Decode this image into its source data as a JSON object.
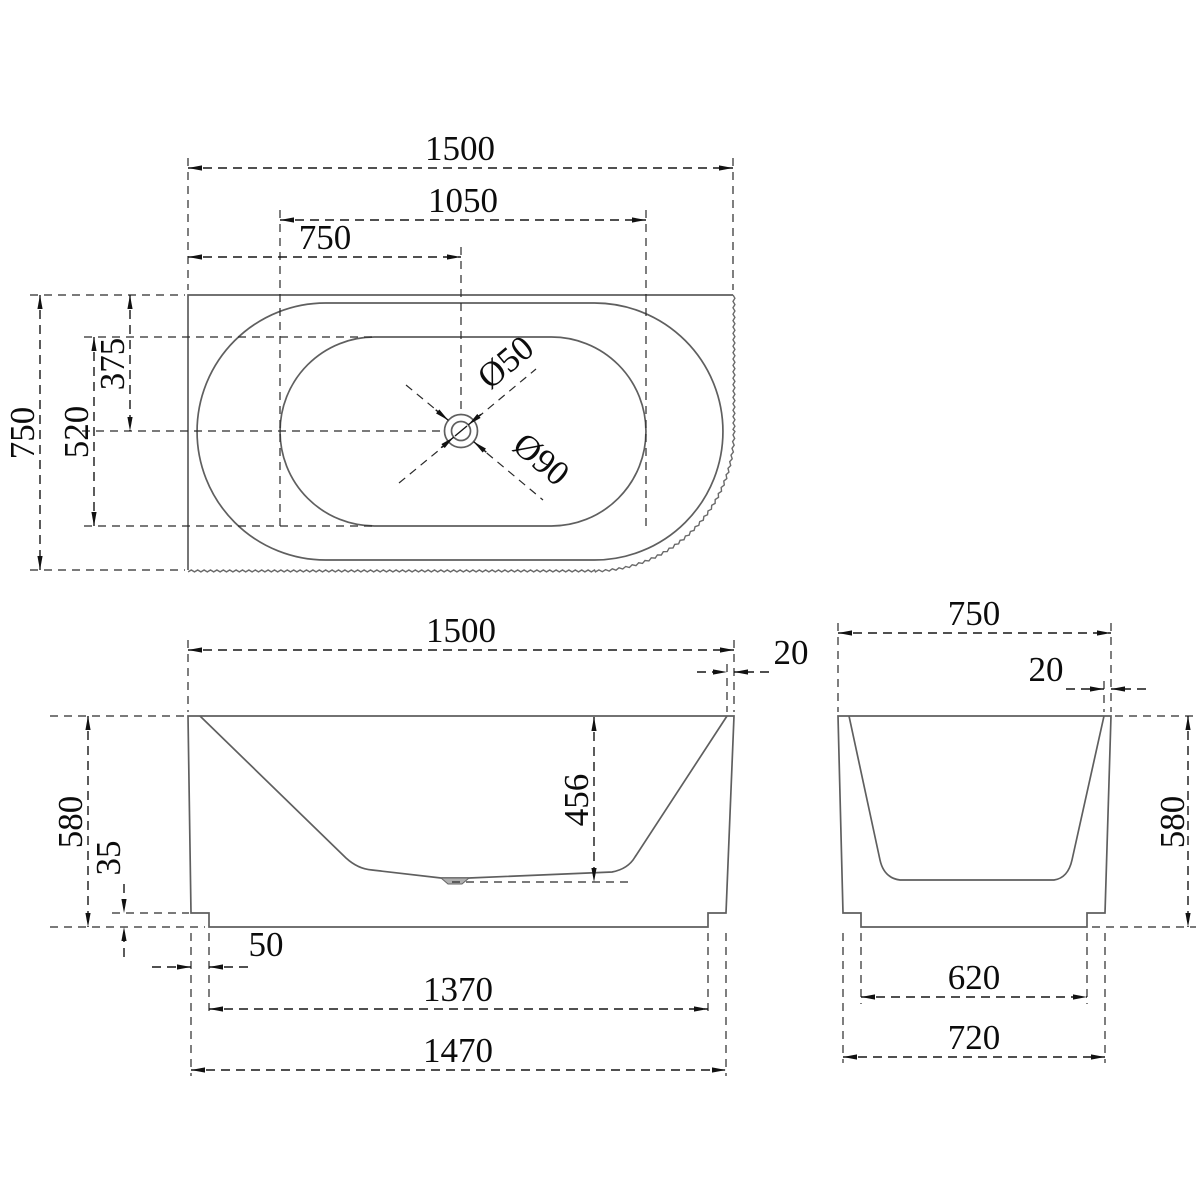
{
  "drawing": {
    "top_view": {
      "overall_length": "1500",
      "floor_length": "1050",
      "drain_offset_x": "750",
      "overall_width": "750",
      "floor_width": "520",
      "drain_offset_y": "375",
      "drain_waste_dia": "Ø50",
      "drain_recess_dia": "Ø90"
    },
    "front_view": {
      "overall_length": "1500",
      "rim_thickness": "20",
      "overall_height": "580",
      "plinth_height": "35",
      "inner_depth": "456",
      "plinth_inset": "50",
      "plinth_length": "1370",
      "base_length": "1470"
    },
    "side_view": {
      "overall_width": "750",
      "rim_thickness": "20",
      "overall_height": "580",
      "plinth_width": "620",
      "base_width": "720"
    }
  },
  "colors": {
    "outline": "#5f5f5f",
    "dimension": "#161616",
    "text": "#0c0c0c",
    "drain_fill": "#b0b0b0",
    "background": "#ffffff"
  }
}
